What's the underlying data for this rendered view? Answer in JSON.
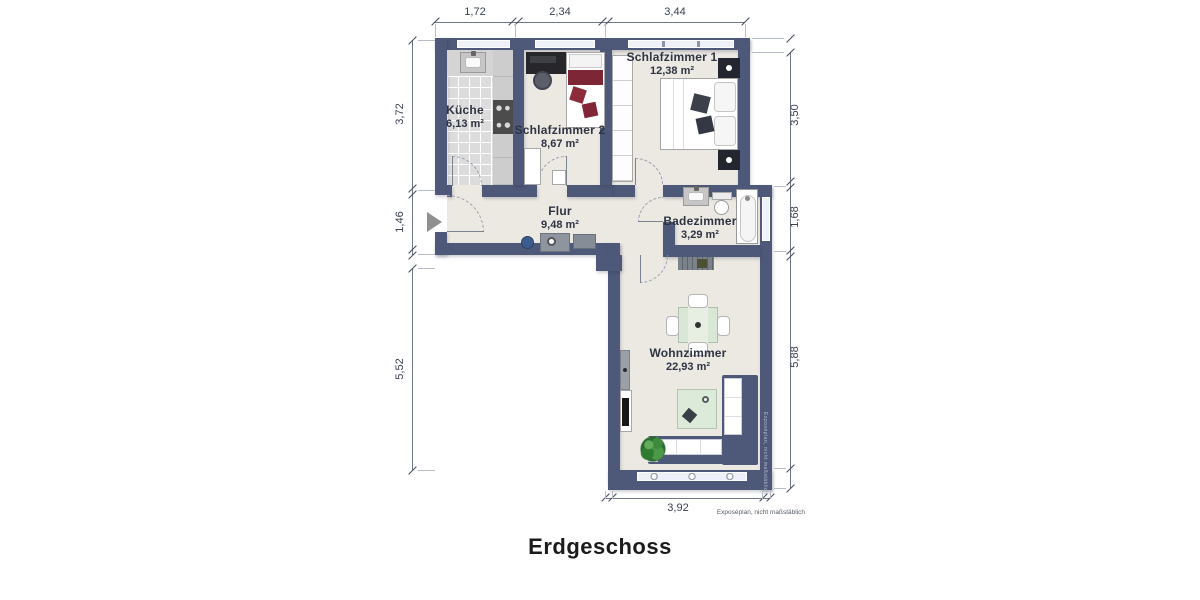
{
  "title": "Erdgeschoss",
  "disclaimer": "Exposéplan, nicht maßstäblich",
  "watermark": "Exposéplan, nicht maßstäblich",
  "rooms": [
    {
      "name": "Küche",
      "area": "6,13 m²"
    },
    {
      "name": "Schlafzimmer 2",
      "area": "8,67 m²"
    },
    {
      "name": "Schlafzimmer 1",
      "area": "12,38 m²"
    },
    {
      "name": "Flur",
      "area": "9,48 m²"
    },
    {
      "name": "Badezimmer",
      "area": "3,29 m²"
    },
    {
      "name": "Wohnzimmer",
      "area": "22,93 m²"
    }
  ],
  "dimensions": {
    "top": [
      "1,72",
      "2,34",
      "3,44"
    ],
    "left": [
      "3,72",
      "1,46",
      "5,52"
    ],
    "right": [
      "3,50",
      "1,68",
      "5,88"
    ],
    "bottom": [
      "3,92"
    ]
  },
  "colors": {
    "wall": "#4e5878",
    "floor": "#ece9e3",
    "kitchen_tile": "#dcdcdc",
    "bed_red": "#7d2636",
    "sofa_blue": "#4e5878",
    "table_green": "#d9e7d6",
    "plant_green": "#357a36"
  }
}
